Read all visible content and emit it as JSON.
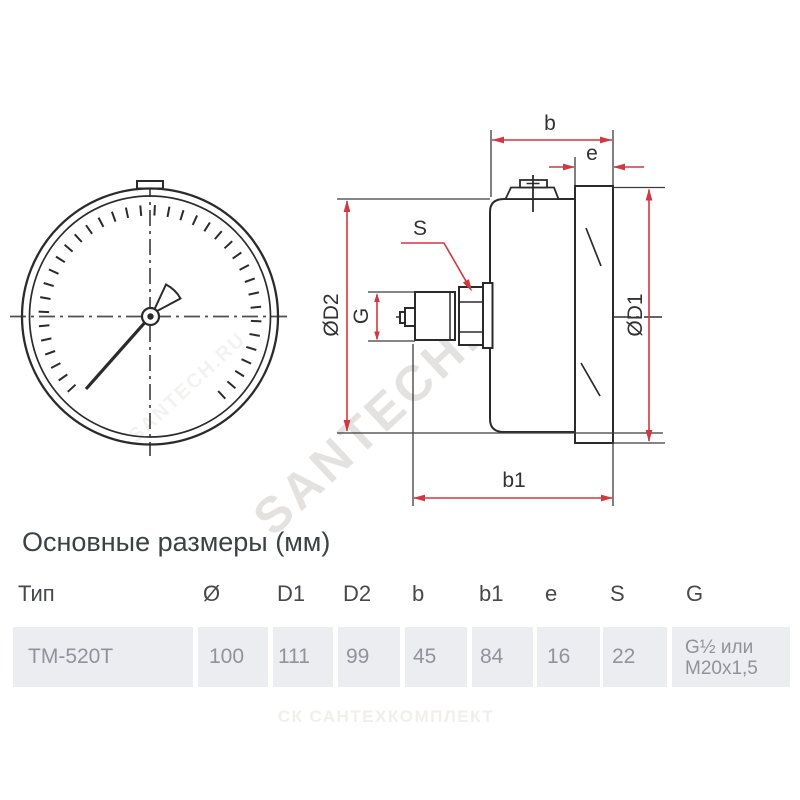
{
  "title": {
    "text": "Основные размеры (мм)"
  },
  "drawing": {
    "labels": {
      "b": "b",
      "e": "e",
      "s": "S",
      "b1": "b1",
      "od2": "ØD2",
      "g": "G",
      "od1": "ØD1"
    },
    "accent_color": "#d23742"
  },
  "watermarks": {
    "diagonal": "SANTECH.RU",
    "diagonal_small": "SANTECH.RU",
    "footer_mark": "СК",
    "footer_text": "САНТЕХКОМПЛЕКТ"
  },
  "table": {
    "headers": {
      "tip": "Тип",
      "d": "Ø",
      "d1": "D1",
      "d2": "D2",
      "b": "b",
      "b1": "b1",
      "e": "e",
      "s": "S",
      "g": "G"
    },
    "row": {
      "tip": "ТМ-520Т",
      "d": "100",
      "d1": "111",
      "d2": "99",
      "b": "45",
      "b1": "84",
      "e": "16",
      "s": "22",
      "g_line1": "G½ или",
      "g_line2": "М20х1,5"
    }
  }
}
